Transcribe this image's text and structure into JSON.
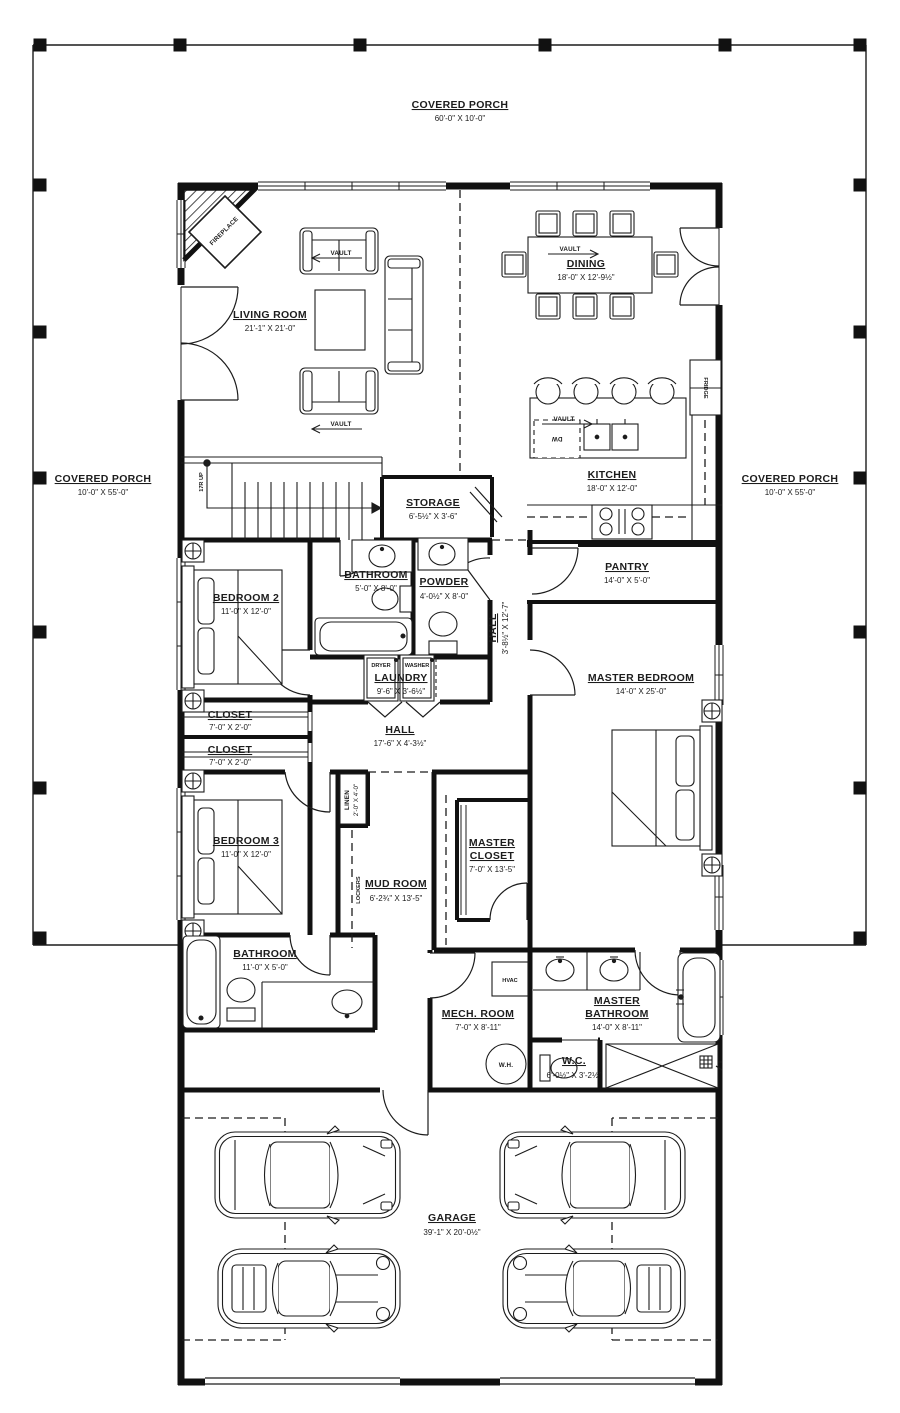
{
  "plan": {
    "title": "First floor plan",
    "colors": {
      "line": "#1c1c1c",
      "bg": "#ffffff"
    },
    "rooms": {
      "covered_porch_top": {
        "name": "COVERED PORCH",
        "dims": "60'-0\" X 10'-0\""
      },
      "covered_porch_left": {
        "name": "COVERED PORCH",
        "dims": "10'-0\" X 55'-0\""
      },
      "covered_porch_right": {
        "name": "COVERED PORCH",
        "dims": "10'-0\" X 55'-0\""
      },
      "living_room": {
        "name": "LIVING ROOM",
        "dims": "21'-1\" X 21'-0\""
      },
      "dining": {
        "name": "DINING",
        "dims": "18'-0\" X 12'-9½\""
      },
      "kitchen": {
        "name": "KITCHEN",
        "dims": "18'-0\" X 12'-0\""
      },
      "storage": {
        "name": "STORAGE",
        "dims": "6'-5½\" X 3'-6\""
      },
      "pantry": {
        "name": "PANTRY",
        "dims": "14'-0\" X 5'-0\""
      },
      "bathroom_hall": {
        "name": "BATHROOM",
        "dims": "5'-0\" X 8'-0\""
      },
      "powder": {
        "name": "POWDER",
        "dims": "4'-0½\" X 8'-0\""
      },
      "hall_vertical": {
        "name": "HALL",
        "dims": "3'-8½\" X 12'-7\""
      },
      "bedroom2": {
        "name": "BEDROOM 2",
        "dims": "11'-0\" X 12'-0\""
      },
      "laundry": {
        "name": "LAUNDRY",
        "dims": "9'-6\" X 3'-6½\""
      },
      "master_bedroom": {
        "name": "MASTER BEDROOM",
        "dims": "14'-0\" X 25'-0\""
      },
      "closet1": {
        "name": "CLOSET",
        "dims": "7'-0\" X 2'-0\""
      },
      "closet2": {
        "name": "CLOSET",
        "dims": "7'-0\" X 2'-0\""
      },
      "hall": {
        "name": "HALL",
        "dims": "17'-6\" X 4'-3½\""
      },
      "linen": {
        "name": "LINEN",
        "dims": "2'-0\" X 4'-0\""
      },
      "bedroom3": {
        "name": "BEDROOM 3",
        "dims": "11'-0\" X 12'-0\""
      },
      "mud_room": {
        "name": "MUD ROOM",
        "dims": "6'-2¾\" X 13'-5\""
      },
      "master_closet": {
        "line1": "MASTER",
        "line2": "CLOSET",
        "dims": "7'-0\" X 13'-5\""
      },
      "bathroom3": {
        "name": "BATHROOM",
        "dims": "11'-0\" X 5'-0\""
      },
      "mech_room": {
        "name": "MECH. ROOM",
        "dims": "7'-0\" X 8'-11\""
      },
      "master_bathroom": {
        "line1": "MASTER",
        "line2": "BATHROOM",
        "dims": "14'-0\" X 8'-11\""
      },
      "wc": {
        "name": "W.C.",
        "dims": "6'-0½\" X 3'-2½\""
      },
      "garage": {
        "name": "GARAGE",
        "dims": "39'-1\" X 20'-0½\""
      }
    },
    "annotations": {
      "fireplace": "FIREPLACE",
      "stairs": "17R UP",
      "vault": "VAULT",
      "dryer": "DRYER",
      "washer": "WASHER",
      "lockers": "LOCKERS",
      "hvac": "HVAC",
      "water_heater": "W.H.",
      "fridge": "FRIDGE",
      "dishwasher": "DW"
    }
  }
}
